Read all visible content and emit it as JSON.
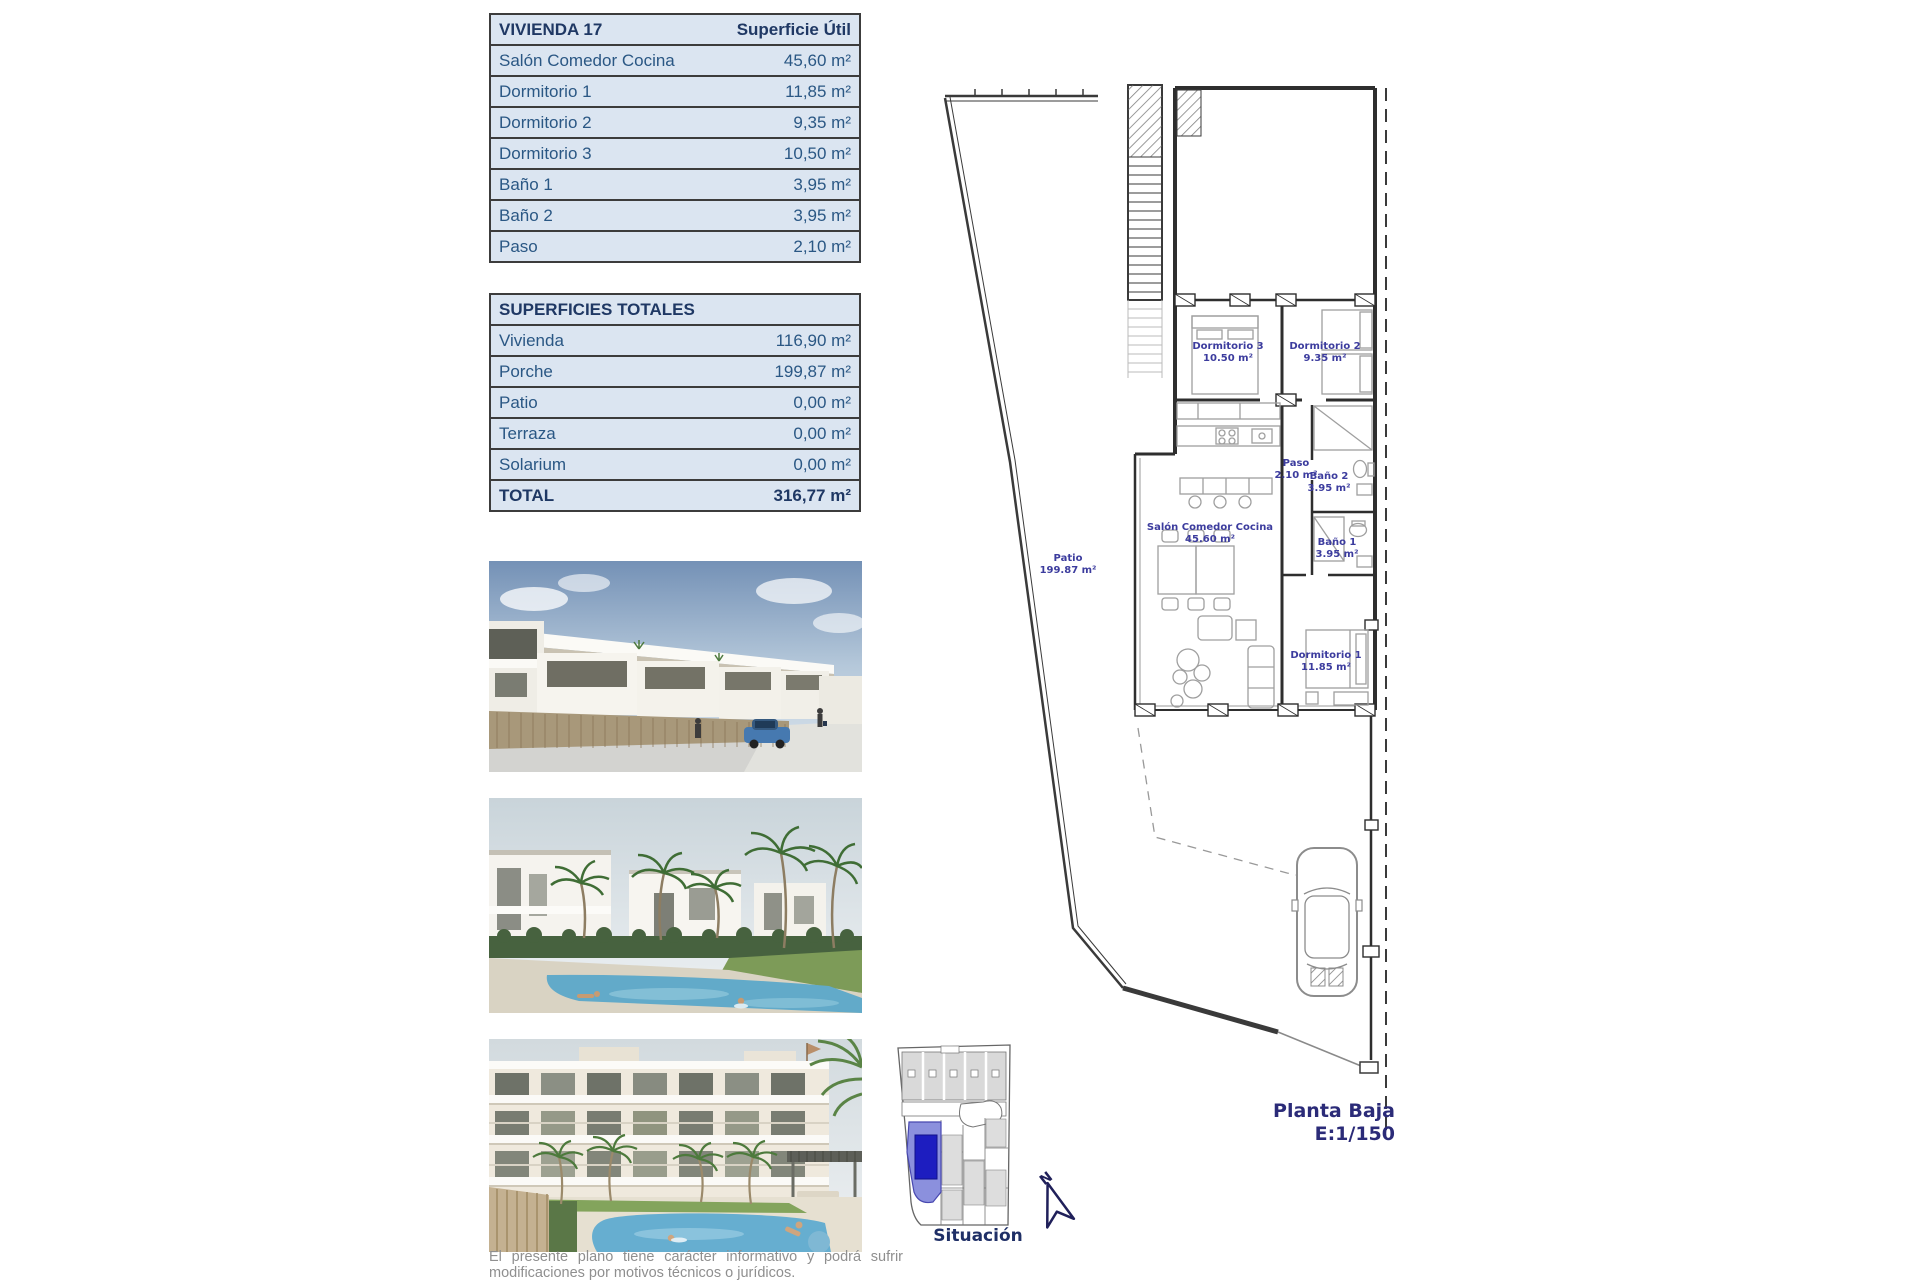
{
  "colors": {
    "table_row_bg": "#dbe5f1",
    "table_border": "#3c3c3c",
    "table_text": "#2a5784",
    "table_header_text": "#1f3864",
    "plan_label_text": "#3c3c9e",
    "caption_text": "#2b2b78",
    "disclaimer_text": "#8f8f8f",
    "situacion_highlight": "#8b90dd",
    "situacion_highlight_dark": "#1d1dc0"
  },
  "vivienda_table": {
    "title": "VIVIENDA 17",
    "superficie_header": "Superficie Útil",
    "rows": [
      {
        "label": "Salón Comedor Cocina",
        "value": "45,60 m²"
      },
      {
        "label": "Dormitorio 1",
        "value": "11,85 m²"
      },
      {
        "label": "Dormitorio 2",
        "value": "9,35 m²"
      },
      {
        "label": "Dormitorio 3",
        "value": "10,50 m²"
      },
      {
        "label": "Baño 1",
        "value": "3,95 m²"
      },
      {
        "label": "Baño 2",
        "value": "3,95 m²"
      },
      {
        "label": "Paso",
        "value": "2,10 m²"
      }
    ]
  },
  "totales_table": {
    "title": "SUPERFICIES TOTALES",
    "rows": [
      {
        "label": "Vivienda",
        "value": "116,90 m²"
      },
      {
        "label": "Porche",
        "value": "199,87 m²"
      },
      {
        "label": "Patio",
        "value": "0,00 m²"
      },
      {
        "label": "Terraza",
        "value": "0,00 m²"
      },
      {
        "label": "Solarium",
        "value": "0,00 m²"
      }
    ],
    "total_label": "TOTAL",
    "total_value": "316,77 m²"
  },
  "floor_plan": {
    "rooms": [
      {
        "name": "Dormitorio 3",
        "area": "10.50 m²"
      },
      {
        "name": "Dormitorio 2",
        "area": "9.35 m²"
      },
      {
        "name": "Paso",
        "area": "2.10 m²"
      },
      {
        "name": "Baño 2",
        "area": "3.95 m²"
      },
      {
        "name": "Baño 1",
        "area": "3.95 m²"
      },
      {
        "name": "Salón Comedor Cocina",
        "area": "45.60 m²"
      },
      {
        "name": "Patio",
        "area": "199.87 m²"
      },
      {
        "name": "Dormitorio 1",
        "area": "11.85 m²"
      }
    ],
    "caption_line1": "Planta Baja",
    "caption_line2": "E:1/150",
    "north_label": "N"
  },
  "situacion": {
    "label": "Situación"
  },
  "disclaimer": {
    "line1": "El presente plano tiene carácter informativo y podrá sufrir",
    "line2": "modificaciones por motivos técnicos o jurídicos."
  }
}
